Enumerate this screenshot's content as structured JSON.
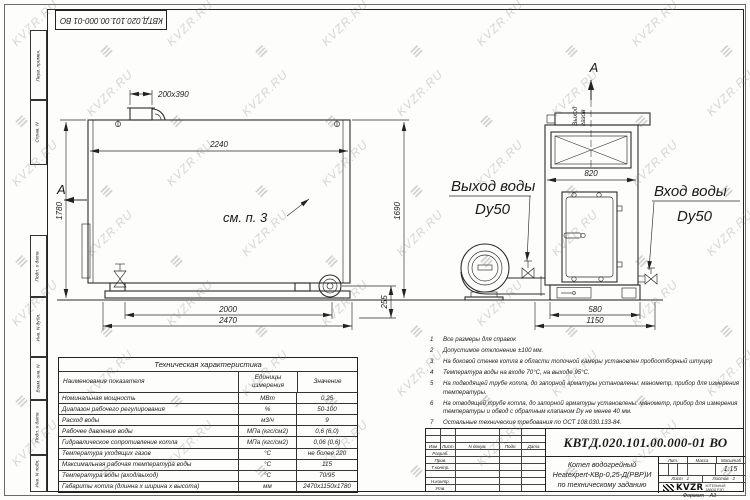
{
  "doc_number": "КВТД.020.101.00.000-01 ВО",
  "watermark": {
    "text": "KVZR.RU",
    "logo_glyph": "≡"
  },
  "side_strip": {
    "labels": [
      "Перв. примен.",
      "Справ. N",
      "Подп. и дата",
      "Инв. N дубл.",
      "Взам. инв. N",
      "Подп. и дата",
      "Инв. N подл."
    ]
  },
  "views": {
    "section_mark": "А",
    "left": {
      "note_ref": "см. п. 3",
      "dims": {
        "stub": "200x390",
        "width_top": "2240",
        "height_left": "1780",
        "height_right": "1690",
        "bottom_inner": "2000",
        "bottom_outer": "2470",
        "foot": "255"
      }
    },
    "right": {
      "gas_out": [
        "Выход",
        "газов"
      ],
      "dims": {
        "width_top": "820",
        "bottom_inner": "580",
        "bottom_outer": "1150"
      }
    },
    "labels": {
      "water_out": "Выход воды",
      "water_out_dn": "Dy50",
      "water_in": "Вход воды",
      "water_in_dn": "Dy50"
    }
  },
  "tech_table": {
    "title": "Техническая характеристика",
    "headers": [
      "Наименование показателя",
      "Единицы измерения",
      "Значение"
    ],
    "rows": [
      [
        "Номинальная мощность",
        "МВт",
        "0,25"
      ],
      [
        "Диапазон рабочего регулирования",
        "%",
        "50-100"
      ],
      [
        "Расход воды",
        "м3/ч",
        "9"
      ],
      [
        "Рабочее давление воды",
        "МПа (кгс/см2)",
        "0,6 (6,0)"
      ],
      [
        "Гидравлическое сопротивление котла",
        "МПа (кгс/см2)",
        "0,06 (0,6)"
      ],
      [
        "Температура уходящих газов",
        "°С",
        "не более 220"
      ],
      [
        "Максимальная рабочая температура воды",
        "°С",
        "115"
      ],
      [
        "Температура воды (вход/выход)",
        "°С",
        "70/95"
      ],
      [
        "Габариты котла (длинна х ширина х высота)",
        "мм",
        "2470х1150х1780"
      ]
    ]
  },
  "notes": [
    {
      "n": "1",
      "text": "Все размеры для справок"
    },
    {
      "n": "2",
      "text": "Допустимое отклонение ±100 мм."
    },
    {
      "n": "3",
      "text": "На боковой стенке котла в области топочной камеры установлен пробоотборный штуцер"
    },
    {
      "n": "4",
      "text": "Температура воды на входе 70°С, на выходе 95°С."
    },
    {
      "n": "5",
      "text": "На подводящей трубе котла, до запорной арматуры установлены: манометр, прибор для измерения температуры."
    },
    {
      "n": "6",
      "text": "На отводящей трубе котла, до запорной арматуры установлены: манометр, прибор для измерения температуры и обвод с обратным клапаном Dу не менее 40 мм."
    },
    {
      "n": "7",
      "text": "Остальные технические требования по ОСТ 108.030.133-84."
    }
  ],
  "title_block": {
    "doc_number": "КВТД.020.101.00.000-01 ВО",
    "name_lines": [
      "Котел водогрейный",
      "Heatexpert-КВр-0,25-Д(РВР)И",
      "по техническому заданию"
    ],
    "header_cols": [
      "Изм",
      "Лист",
      "N докум.",
      "Подп.",
      "Дата"
    ],
    "row_labels": [
      "Разраб.",
      "Пров.",
      "Т.контр.",
      "",
      "Н.контр.",
      "Утв."
    ],
    "lit_label": "Лит.",
    "massa_label": "Масса",
    "masshtab_label": "Масштаб",
    "masshtab_value": "1:15",
    "sheet_label": "Лист",
    "sheet_value": "1",
    "sheets_label": "Листов",
    "sheets_value": "2",
    "logo_text": "KVZR",
    "logo_caption": [
      "КОТЕЛЬНЫЙ",
      "ЗАВОД РЭП"
    ],
    "format_label": "Формат",
    "format_value": "А3"
  }
}
